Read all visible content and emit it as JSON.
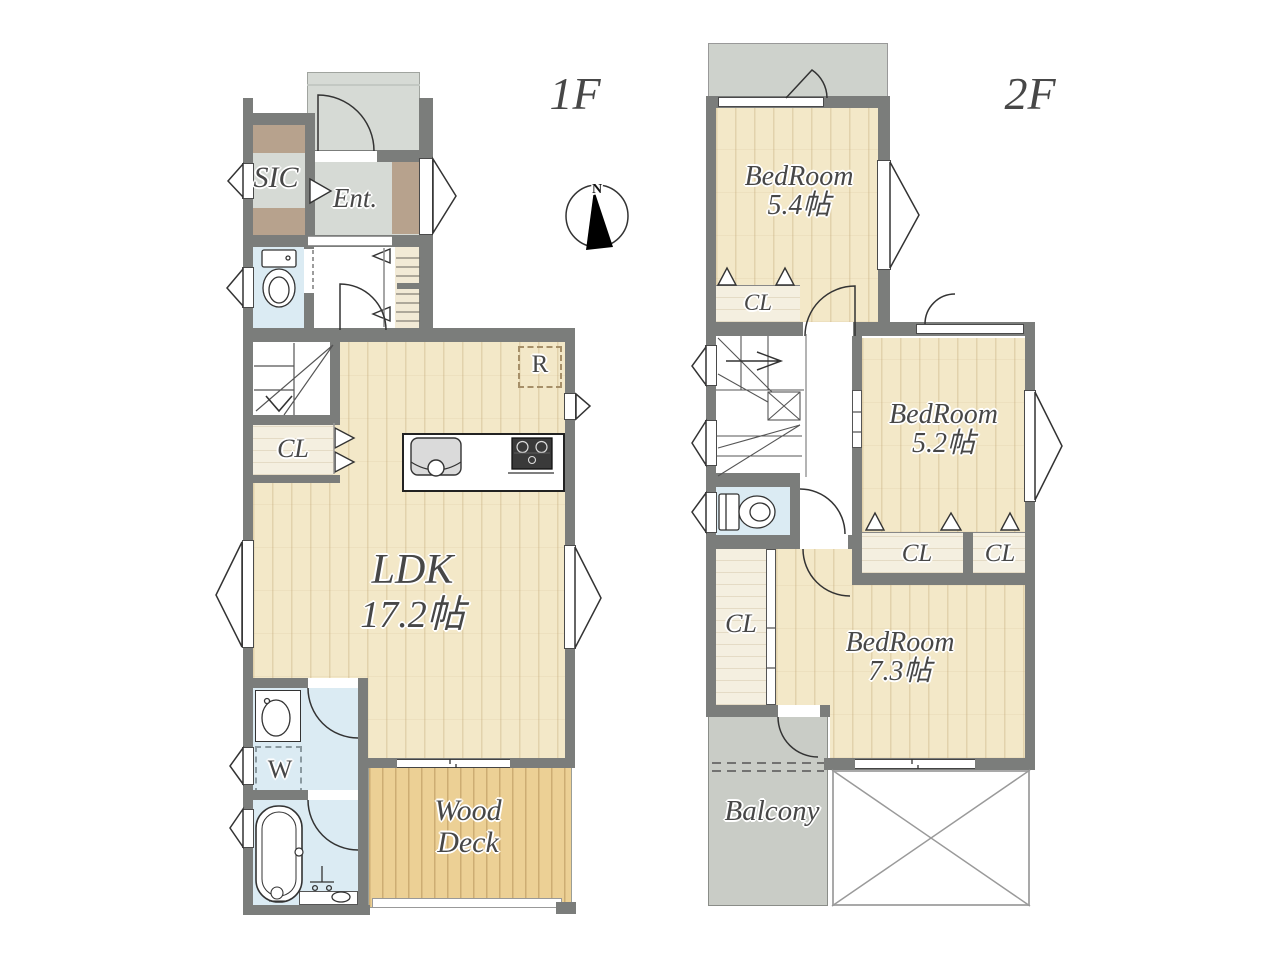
{
  "compass": {
    "north": "N"
  },
  "colors": {
    "wall": "#7b7d7b",
    "wood_floor": "#f3e8c8",
    "deck": "#ecd095",
    "water_room": "#dbebf3",
    "gray_floor": "#d6dad5",
    "roof": "#ced2cc",
    "balcony": "#c9ccc6",
    "accent_brown": "#b7a28d",
    "closet_floor": "#f4efe0",
    "label_text": "#474747"
  },
  "floor1": {
    "label": "1F",
    "rooms": {
      "sic": "SIC",
      "entrance": "Ent.",
      "closet": "CL",
      "ldk_name": "LDK",
      "ldk_size": "17.2帖",
      "refrigerator": "R",
      "washer": "W",
      "wood_deck_line1": "Wood",
      "wood_deck_line2": "Deck"
    }
  },
  "floor2": {
    "label": "2F",
    "rooms": {
      "bedroom1_name": "BedRoom",
      "bedroom1_size": "5.4帖",
      "bedroom1_closet": "CL",
      "bedroom2_name": "BedRoom",
      "bedroom2_size": "5.2帖",
      "bedroom2_closet_left": "CL",
      "bedroom2_closet_right": "CL",
      "hall_closet": "CL",
      "bedroom3_name": "BedRoom",
      "bedroom3_size": "7.3帖",
      "balcony": "Balcony"
    }
  }
}
